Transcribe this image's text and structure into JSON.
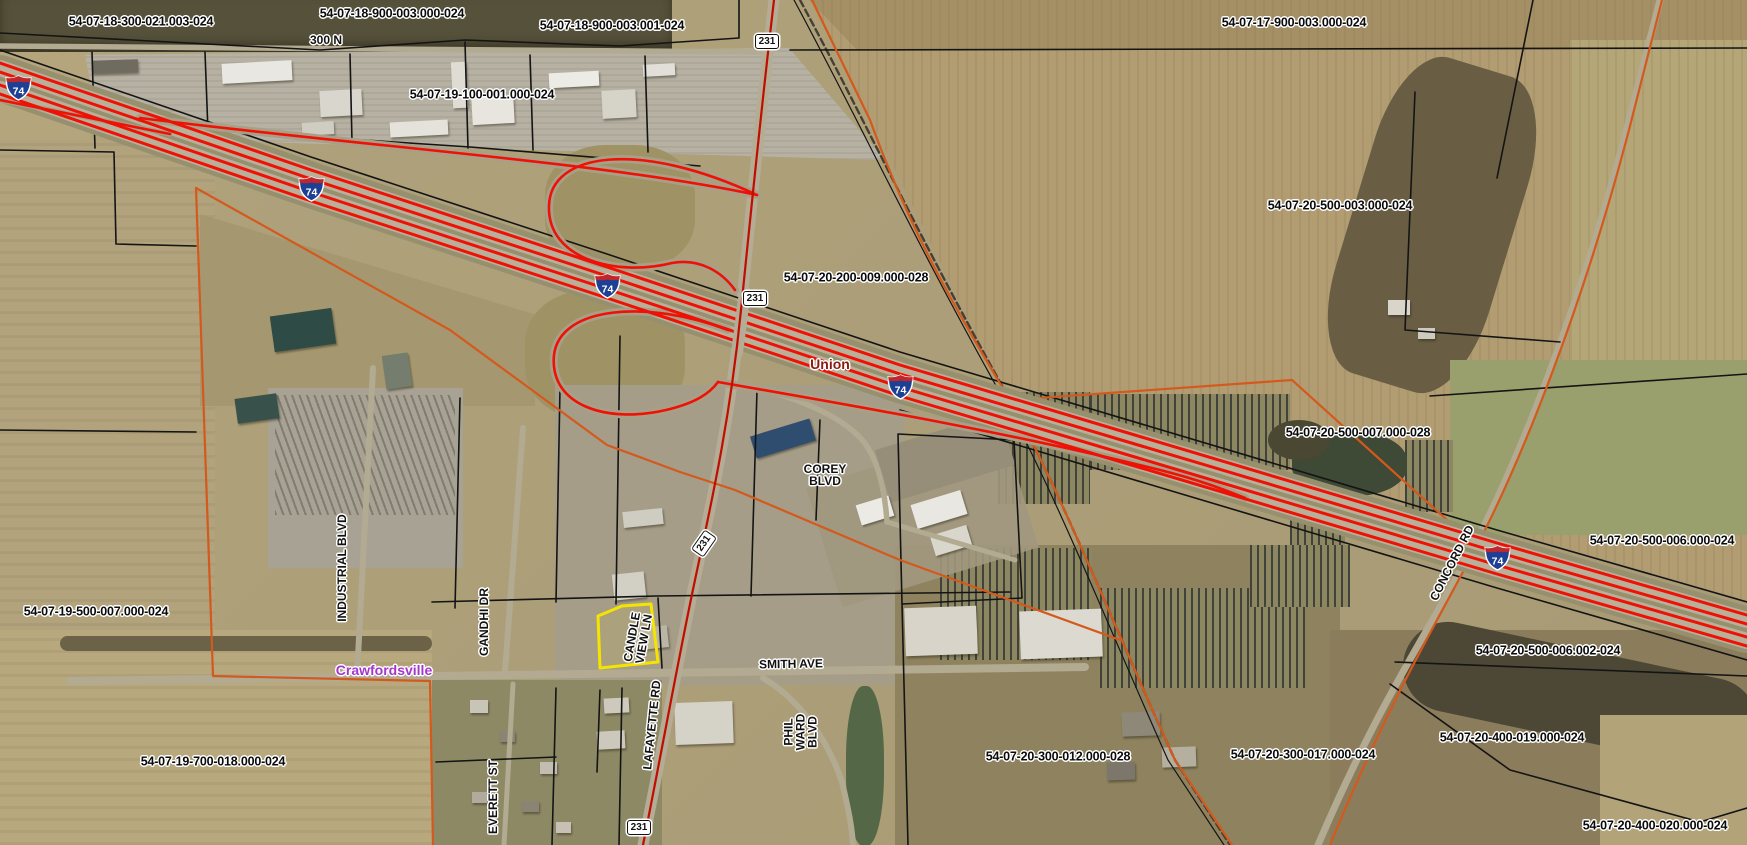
{
  "map": {
    "parcel_labels": [
      {
        "text": "54-07-18-300-021.003-024",
        "x": 141,
        "y": 22
      },
      {
        "text": "54-07-18-900-003.000-024",
        "x": 392,
        "y": 14
      },
      {
        "text": "54-07-18-900-003.001-024",
        "x": 612,
        "y": 26
      },
      {
        "text": "54-07-17-900-003.000-024",
        "x": 1294,
        "y": 23
      },
      {
        "text": "54-07-19-100-001.000-024",
        "x": 482,
        "y": 95
      },
      {
        "text": "54-07-20-500-003.000-024",
        "x": 1340,
        "y": 206
      },
      {
        "text": "54-07-20-200-009.000-028",
        "x": 856,
        "y": 278
      },
      {
        "text": "54-07-20-500-007.000-028",
        "x": 1358,
        "y": 433
      },
      {
        "text": "54-07-20-500-006.000-024",
        "x": 1662,
        "y": 541
      },
      {
        "text": "54-07-19-500-007.000-024",
        "x": 96,
        "y": 612
      },
      {
        "text": "54-07-20-500-006.002-024",
        "x": 1548,
        "y": 651
      },
      {
        "text": "54-07-20-300-012.000-028",
        "x": 1058,
        "y": 757
      },
      {
        "text": "54-07-20-300-017.000-024",
        "x": 1303,
        "y": 755
      },
      {
        "text": "54-07-20-400-019.000-024",
        "x": 1512,
        "y": 738
      },
      {
        "text": "54-07-19-700-018.000-024",
        "x": 213,
        "y": 762
      },
      {
        "text": "54-07-20-400-020.000-024",
        "x": 1655,
        "y": 826
      }
    ],
    "road_labels": [
      {
        "text": "300 N",
        "x": 326,
        "y": 40,
        "rot": 0
      },
      {
        "text": "SMITH AVE",
        "x": 791,
        "y": 664,
        "rot": -1
      },
      {
        "text": "COREY\nBLVD",
        "x": 825,
        "y": 475,
        "rot": 0
      },
      {
        "text": "CANDLE\nVIEW LN",
        "x": 638,
        "y": 638,
        "rot": -80
      },
      {
        "text": "INDUSTRIAL BLVD",
        "x": 342,
        "y": 568,
        "rot": -90
      },
      {
        "text": "GANDHI DR",
        "x": 484,
        "y": 622,
        "rot": -90
      },
      {
        "text": "LAFAYETTE RD",
        "x": 652,
        "y": 725,
        "rot": -84
      },
      {
        "text": "PHIL\nWARD\nBLVD",
        "x": 801,
        "y": 732,
        "rot": -90
      },
      {
        "text": "EVERETT ST",
        "x": 493,
        "y": 797,
        "rot": -90
      },
      {
        "text": "CONCORD RD",
        "x": 1452,
        "y": 563,
        "rot": -63
      }
    ],
    "place_labels": [
      {
        "text": "Union",
        "x": 830,
        "y": 364,
        "color": "#8a1b12"
      },
      {
        "text": "Crawfordsville",
        "x": 384,
        "y": 670,
        "color": "#a535cc"
      }
    ],
    "shields": {
      "interstate": {
        "label": "74",
        "positions": [
          {
            "x": 18,
            "y": 88
          },
          {
            "x": 311,
            "y": 189
          },
          {
            "x": 607,
            "y": 286
          },
          {
            "x": 900,
            "y": 387
          },
          {
            "x": 1497,
            "y": 558
          }
        ]
      },
      "us_route": {
        "label": "231",
        "positions": [
          {
            "x": 767,
            "y": 42,
            "rot": 0
          },
          {
            "x": 755,
            "y": 299,
            "rot": 0
          },
          {
            "x": 704,
            "y": 544,
            "rot": -55
          },
          {
            "x": 639,
            "y": 828,
            "rot": 0
          }
        ]
      }
    },
    "colors": {
      "highway_red": "#ef1105",
      "route_centerline_red": "#c00d00",
      "municipal_boundary_orange": "#d4591c",
      "parcel_line_black": "#141414",
      "selected_parcel_yellow": "#f5e400",
      "interstate_blue": "#1d3f94",
      "interstate_crest_red": "#c0272d",
      "union_label_color": "#8a1b12",
      "crawfordsville_label_color": "#a535cc"
    }
  }
}
